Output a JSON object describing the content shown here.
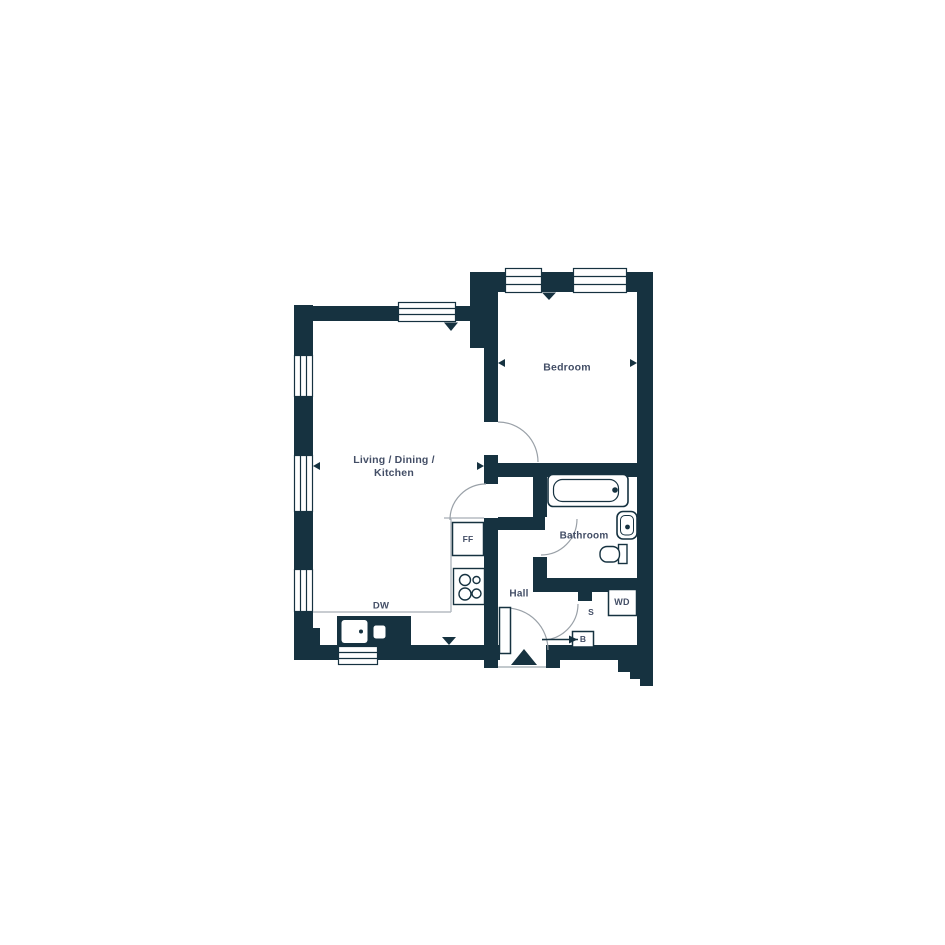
{
  "title": "One bedroom apartment floor plan",
  "colors": {
    "wall": "#163240",
    "label": "#434e66",
    "counter_line": "#b6bcc2",
    "door_arc": "#9aa1a8",
    "background": "#ffffff"
  },
  "rooms": {
    "living": {
      "line1": "Living / Dining /",
      "line2": "Kitchen"
    },
    "bedroom": {
      "label": "Bedroom"
    },
    "bathroom": {
      "label": "Bathroom"
    },
    "hall": {
      "label": "Hall"
    }
  },
  "appliances": {
    "fridge_freezer": "FF",
    "dishwasher": "DW",
    "washer_dryer": "WD",
    "storage": "S",
    "boiler": "B"
  }
}
